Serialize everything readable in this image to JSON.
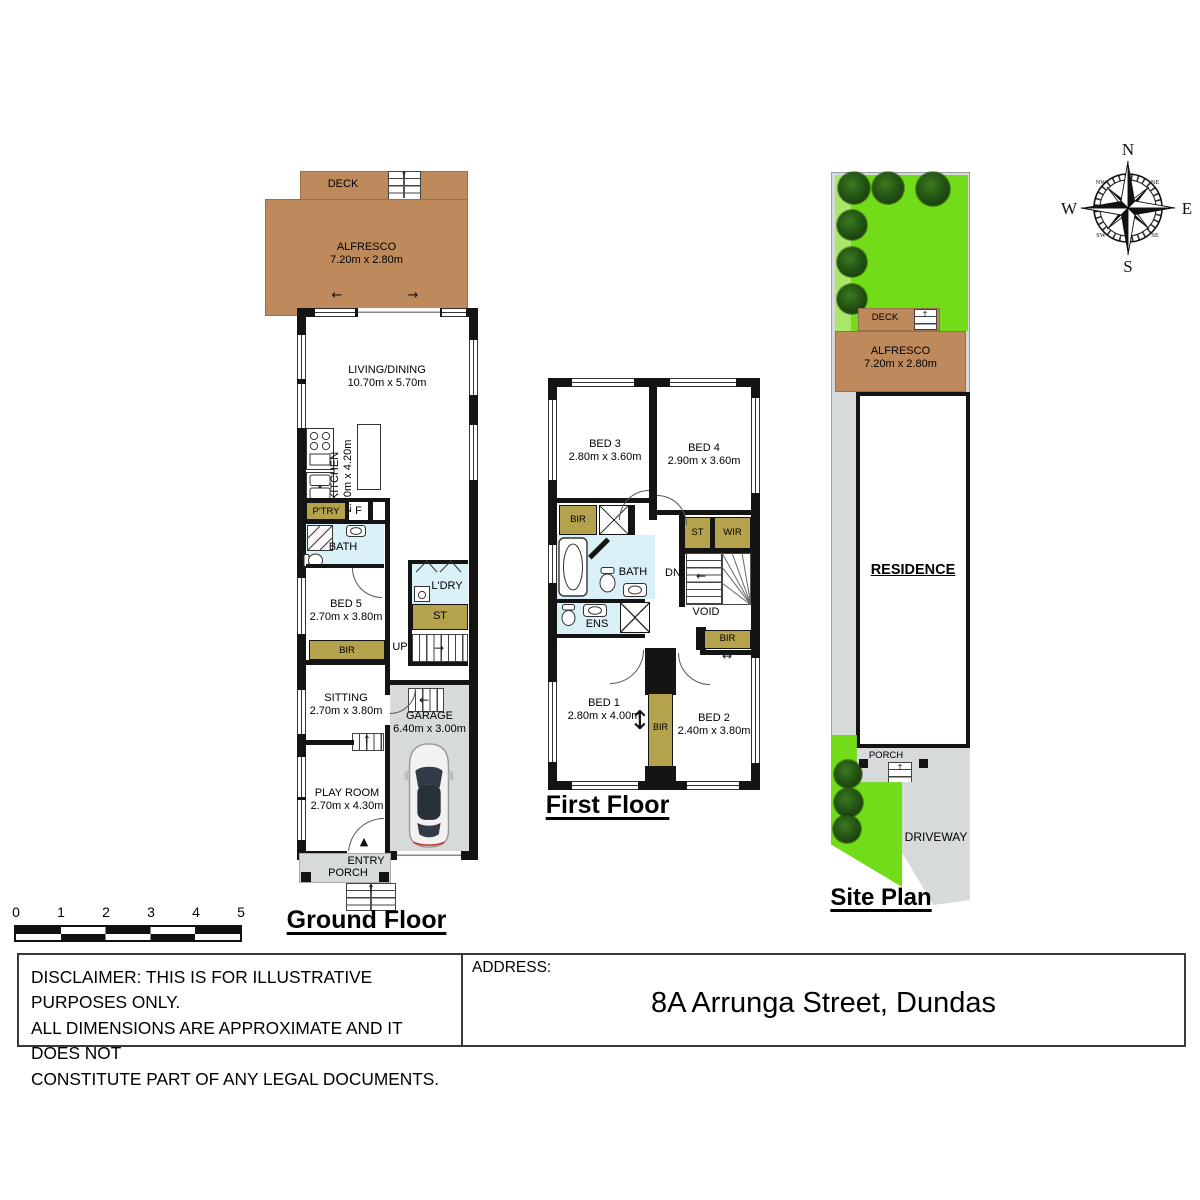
{
  "colors": {
    "alfresco_brown": "#bf8a5b",
    "robe_khaki": "#b4a24c",
    "wet_blue": "#d8f0f6",
    "hard_grey": "#d6dada",
    "lawn_green": "#72dc18",
    "lawn_light": "#a9e768",
    "tree_green": "#245313",
    "wall_black": "#141414"
  },
  "ground": {
    "title": "Ground Floor",
    "deck": {
      "name": "DECK"
    },
    "alfresco": {
      "name": "ALFRESCO",
      "dims": "7.20m x 2.80m"
    },
    "living": {
      "name": "LIVING/DINING",
      "dims": "10.70m x 5.70m"
    },
    "kitchen": {
      "name": "KITCHEN",
      "dims": "2.70m x 4.20m"
    },
    "pantry": {
      "name": "P'TRY"
    },
    "fridge": {
      "name": "F"
    },
    "bath": {
      "name": "BATH"
    },
    "bed5": {
      "name": "BED 5",
      "dims": "2.70m x 3.80m"
    },
    "bir": {
      "name": "BIR"
    },
    "ldry": {
      "name": "L'DRY"
    },
    "st": {
      "name": "ST"
    },
    "up": {
      "name": "UP"
    },
    "sitting": {
      "name": "SITTING",
      "dims": "2.70m x 3.80m"
    },
    "garage": {
      "name": "GARAGE",
      "dims": "6.40m x 3.00m"
    },
    "playroom": {
      "name": "PLAY ROOM",
      "dims": "2.70m x 4.30m"
    },
    "entry": {
      "line1": "ENTRY",
      "line2": "PORCH"
    }
  },
  "first": {
    "title": "First Floor",
    "bed3": {
      "name": "BED 3",
      "dims": "2.80m x 3.60m"
    },
    "bed4": {
      "name": "BED 4",
      "dims": "2.90m x 3.60m"
    },
    "bir_left": {
      "name": "BIR"
    },
    "st": {
      "name": "ST"
    },
    "wir": {
      "name": "WIR"
    },
    "bath": {
      "name": "BATH"
    },
    "dn": {
      "name": "DN"
    },
    "ens": {
      "name": "ENS"
    },
    "void": {
      "name": "VOID"
    },
    "bir_right": {
      "name": "BIR"
    },
    "bed1": {
      "name": "BED 1",
      "dims": "2.80m x 4.00m"
    },
    "bir_mid": {
      "name": "BIR"
    },
    "bed2": {
      "name": "BED 2",
      "dims": "2.40m x 3.80m"
    }
  },
  "site": {
    "title": "Site Plan",
    "deck": {
      "name": "DECK"
    },
    "alfresco": {
      "name": "ALFRESCO",
      "dims": "7.20m x 2.80m"
    },
    "residence": {
      "name": "RESIDENCE"
    },
    "porch": {
      "name": "PORCH"
    },
    "driveway": {
      "name": "DRIVEWAY"
    }
  },
  "compass": {
    "n": "N",
    "e": "E",
    "s": "S",
    "w": "W",
    "nw": "NW",
    "ne": "NE",
    "sw": "SW",
    "se": "SE"
  },
  "scalebar": {
    "ticks": [
      "0",
      "1",
      "2",
      "3",
      "4",
      "5"
    ]
  },
  "icons": {
    "stair_up": "↑",
    "arrow_left": "←",
    "arrow_right": "→",
    "entry_arrow": "▲",
    "double_arrow_h": "↔",
    "double_arrow_v": "↕"
  },
  "footer": {
    "disclaimer_lines": [
      "DISCLAIMER: THIS IS FOR ILLUSTRATIVE PURPOSES ONLY.",
      "ALL DIMENSIONS ARE APPROXIMATE AND IT DOES NOT",
      "CONSTITUTE PART OF ANY LEGAL DOCUMENTS."
    ],
    "address_label": "ADDRESS:",
    "address": "8A Arrunga Street, Dundas"
  }
}
